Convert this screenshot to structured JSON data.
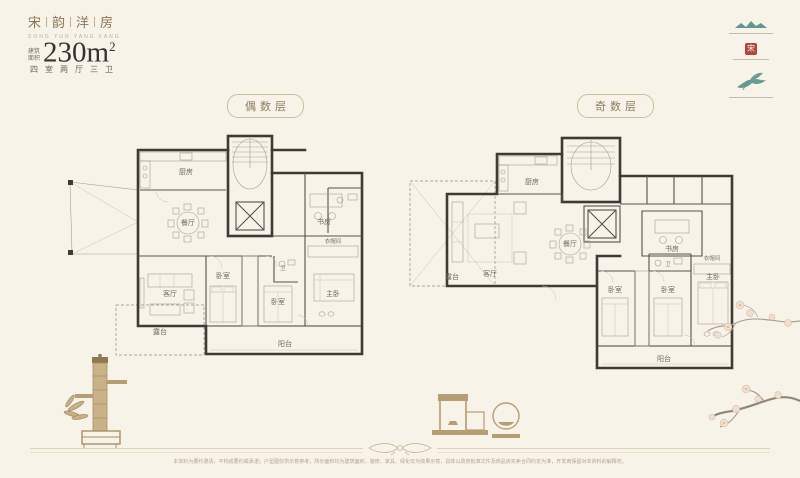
{
  "brand": {
    "chars": [
      "宋",
      "韵",
      "洋",
      "房"
    ],
    "subtitle": "SONG YUN YANG FANG"
  },
  "unit": {
    "area_label_top": "建筑",
    "area_label_bottom": "面积",
    "area_value": "230m",
    "area_sup": "2",
    "spec": "四室两厅三卫"
  },
  "logos": {
    "seal_glyph": "宋"
  },
  "plans": [
    {
      "badge": "偶数层",
      "rooms": [
        "厨房",
        "餐厅",
        "客厅",
        "卧室",
        "卫",
        "卧室",
        "书房",
        "主卧",
        "衣帽间",
        "阳台",
        "露台"
      ]
    },
    {
      "badge": "奇数层",
      "rooms": [
        "厨房",
        "餐厅",
        "客厅",
        "卧室",
        "卫",
        "卧室",
        "书房",
        "主卧",
        "衣帽间",
        "阳台",
        "露台"
      ]
    }
  ],
  "footer": {
    "disclaimer": "本资料为要约邀请，不构成要约或承诺；户型图仅供示意参考，所示面积均为建筑面积，装修、家具、绿化仅为效果示意，具体以政府批准文件及商品房买卖合同约定为准，开发商保留对本资料的解释权。"
  },
  "colors": {
    "accent_teal": "#4f8d84",
    "seal_red": "#b0453c",
    "tan": "#b79d72",
    "wall": "#3e3a35"
  }
}
